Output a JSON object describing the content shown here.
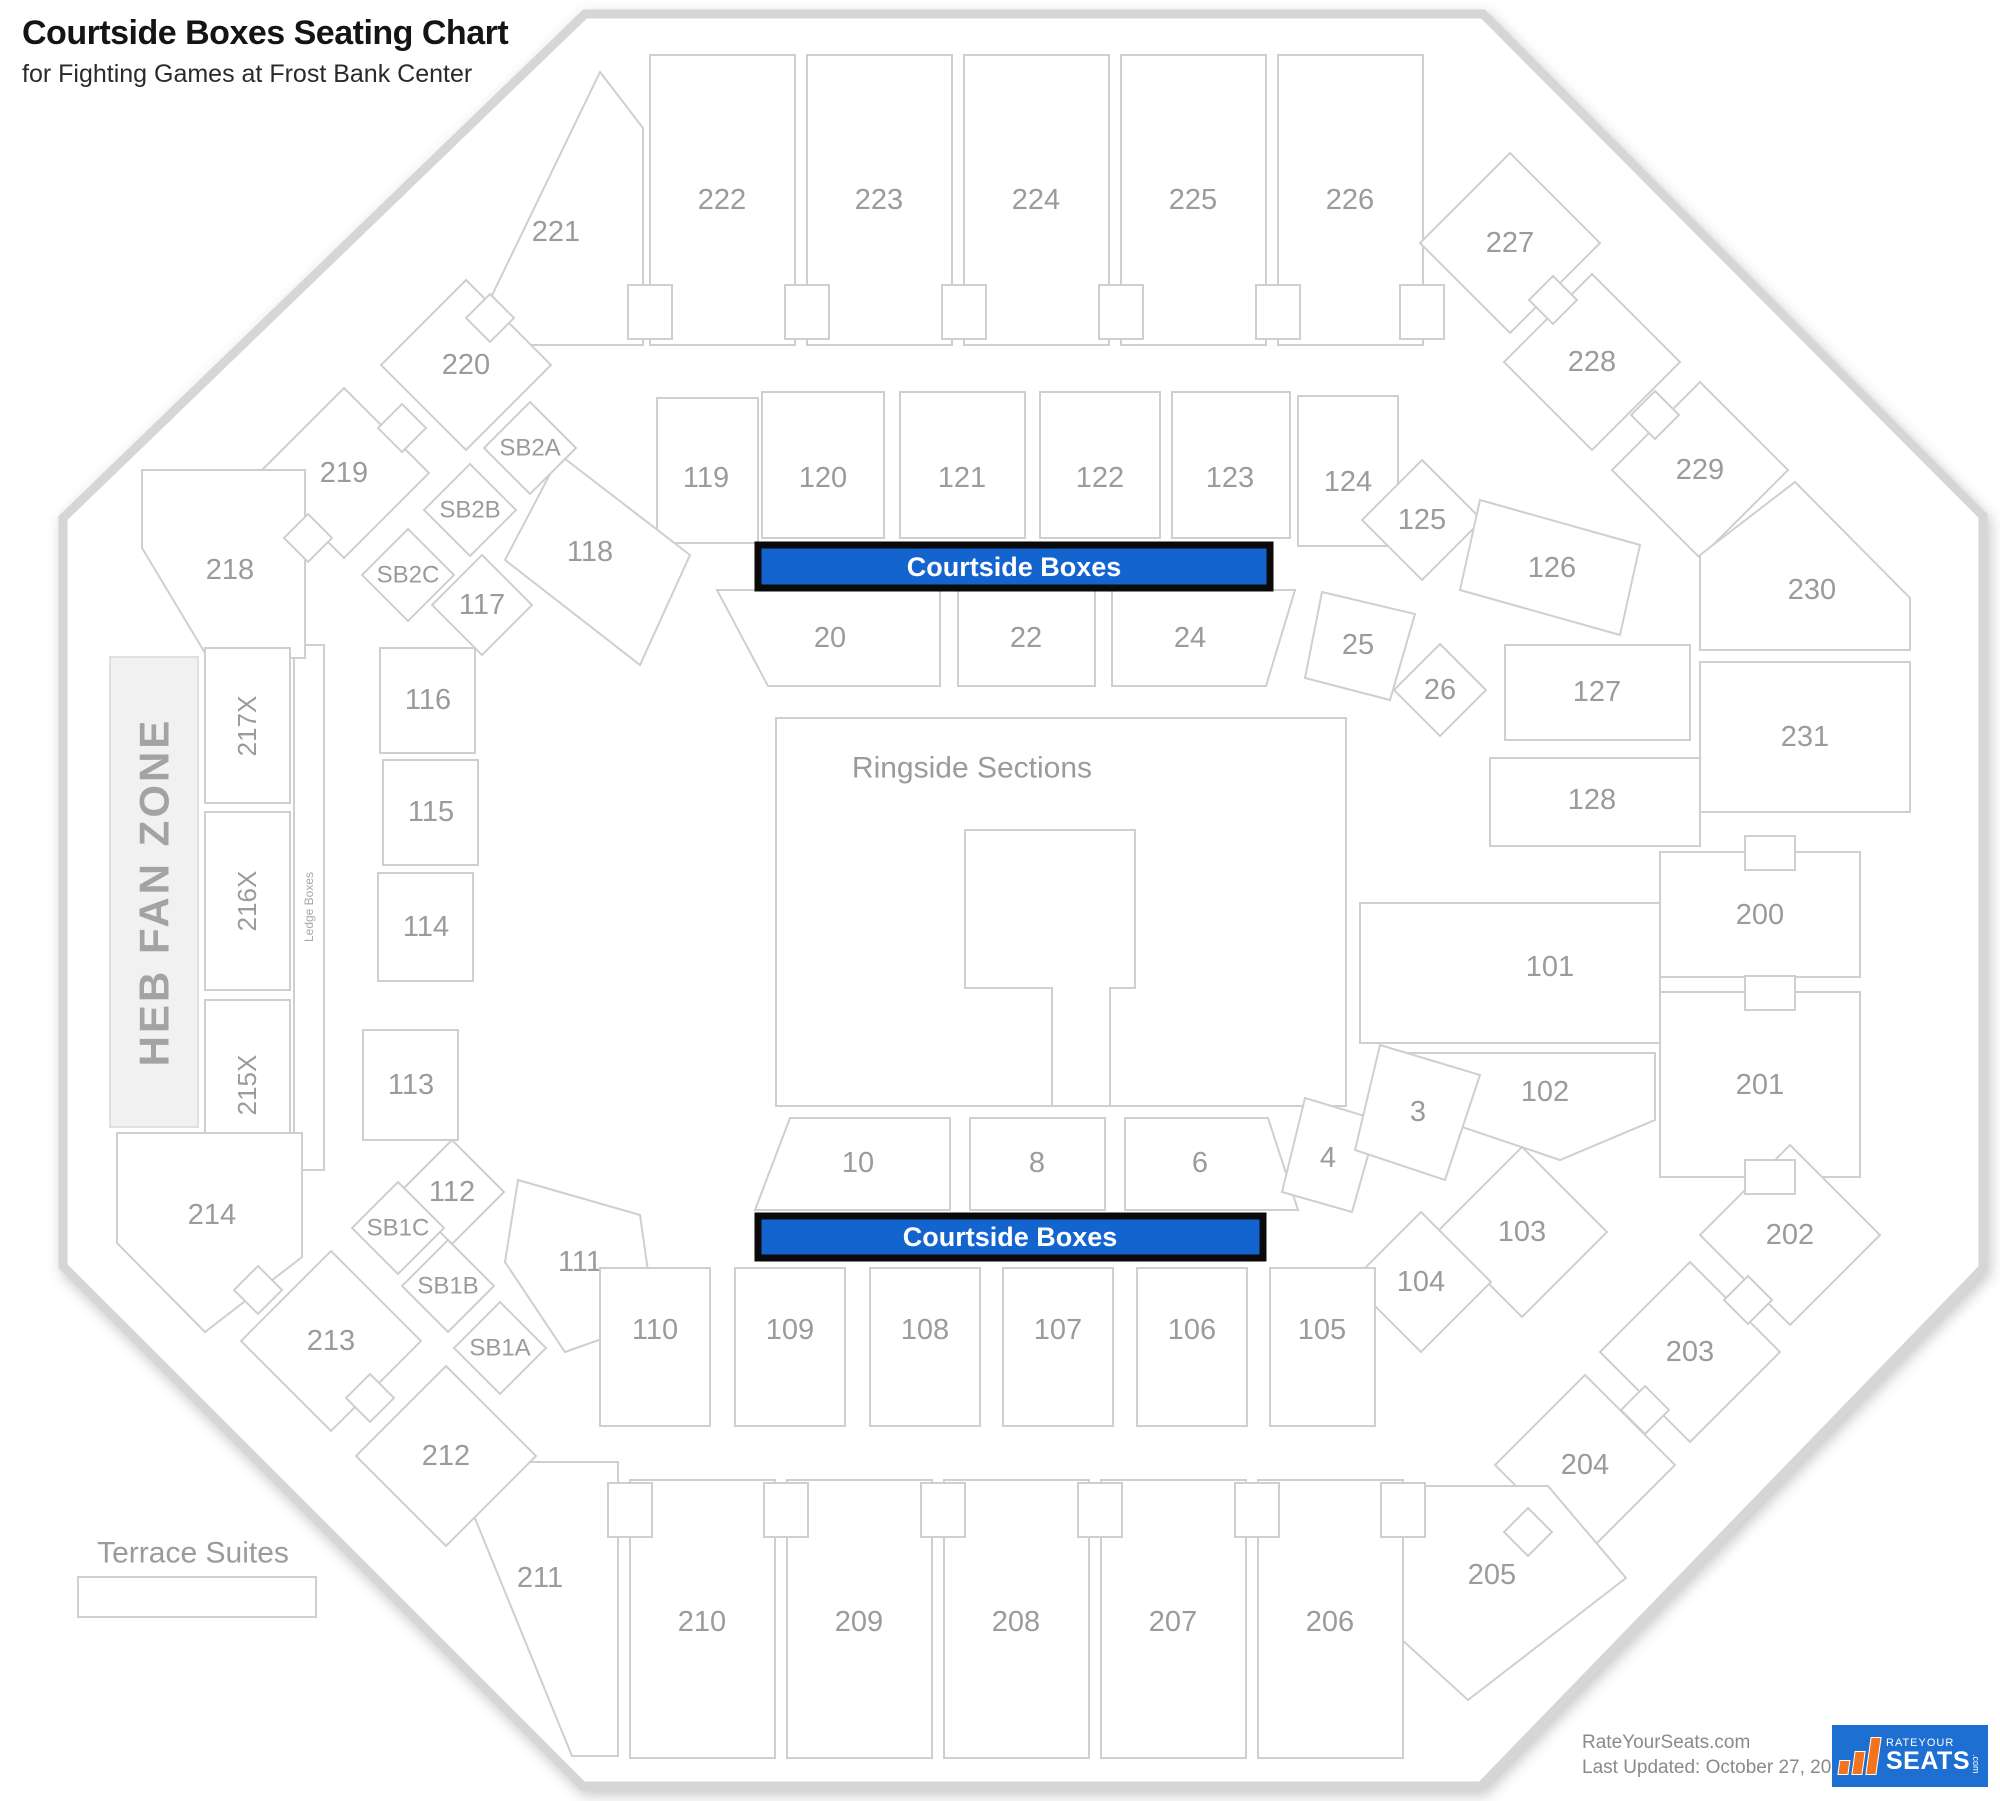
{
  "header": {
    "title": "Courtside Boxes Seating Chart",
    "subtitle": "for Fighting Games at Frost Bank Center"
  },
  "bars": {
    "top": "Courtside Boxes",
    "bottom": "Courtside Boxes"
  },
  "labels": {
    "ringside": "Ringside Sections",
    "heb_fan_zone": "HEB FAN ZONE",
    "ledge_boxes": "Ledge Boxes",
    "terrace_suites": "Terrace Suites"
  },
  "colors": {
    "highlight_blue": "#1464d0",
    "logo_blue": "#1d6fd2",
    "logo_orange": "#f4731f",
    "section_line": "#cfcfcf",
    "label_gray": "#9b9b9b"
  },
  "sections": {
    "s3": "3",
    "s4": "4",
    "s6": "6",
    "s8": "8",
    "s10": "10",
    "s20": "20",
    "s22": "22",
    "s24": "24",
    "s25": "25",
    "s26": "26",
    "s101": "101",
    "s102": "102",
    "s103": "103",
    "s104": "104",
    "s105": "105",
    "s106": "106",
    "s107": "107",
    "s108": "108",
    "s109": "109",
    "s110": "110",
    "s111": "111",
    "s112": "112",
    "s113": "113",
    "s114": "114",
    "s115": "115",
    "s116": "116",
    "s117": "117",
    "s118": "118",
    "s119": "119",
    "s120": "120",
    "s121": "121",
    "s122": "122",
    "s123": "123",
    "s124": "124",
    "s125": "125",
    "s126": "126",
    "s127": "127",
    "s128": "128",
    "s200": "200",
    "s201": "201",
    "s202": "202",
    "s203": "203",
    "s204": "204",
    "s205": "205",
    "s206": "206",
    "s207": "207",
    "s208": "208",
    "s209": "209",
    "s210": "210",
    "s211": "211",
    "s212": "212",
    "s213": "213",
    "s214": "214",
    "s215x": "215X",
    "s216x": "216X",
    "s217x": "217X",
    "s218": "218",
    "s219": "219",
    "s220": "220",
    "s221": "221",
    "s222": "222",
    "s223": "223",
    "s224": "224",
    "s225": "225",
    "s226": "226",
    "s227": "227",
    "s228": "228",
    "s229": "229",
    "s230": "230",
    "s231": "231",
    "sb1a": "SB1A",
    "sb1b": "SB1B",
    "sb1c": "SB1C",
    "sb2a": "SB2A",
    "sb2b": "SB2B",
    "sb2c": "SB2C"
  },
  "footer": {
    "site": "RateYourSeats.com",
    "updated": "Last Updated: October 27, 2025",
    "logo_line1": "RATEYOUR",
    "logo_line2": "SEATS",
    "logo_com": ".com"
  }
}
